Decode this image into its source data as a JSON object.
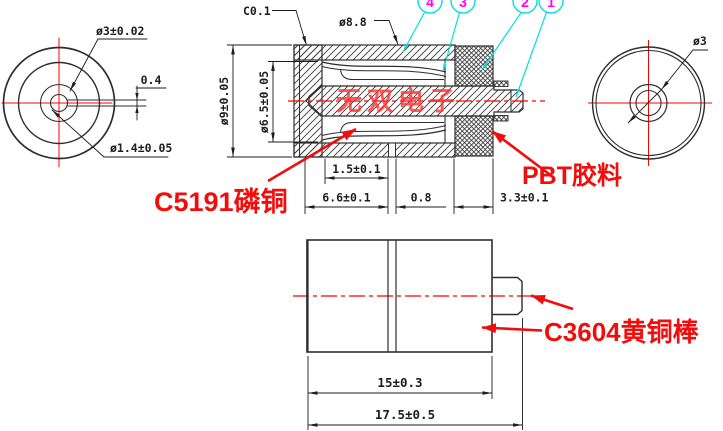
{
  "drawing": {
    "watermark": "无双电子",
    "colors": {
      "line": "#2e2e2e",
      "accent_red": "#f20d0d",
      "centerline_red": "#ff0000",
      "balloon_cyan": "#00e0e0",
      "balloon_num_magenta": "#ff00ff"
    },
    "balloons": [
      "4",
      "3",
      "2",
      "1"
    ],
    "left_view": {
      "outer_dia": "ø3±0.02",
      "slot_width": "0.4",
      "pin_dia": "ø1.4±0.05"
    },
    "section_view": {
      "chamfer": "C0.1",
      "shell_outer_dia": "ø8.8",
      "body_dia": "ø9±0.05",
      "bore_dia": "ø6.5±0.05",
      "dim_slot_pos": "1.5±0.1",
      "dim_front_len": "6.6±0.1",
      "dim_slot": "0.8",
      "dim_pbt_len": "3.3±0.1",
      "label_spring": "C5191磷铜",
      "label_plastic": "PBT胶料"
    },
    "right_view": {
      "pin_dia": "ø3"
    },
    "bottom_view": {
      "dim_body_len": "15±0.3",
      "dim_total_len": "17.5±0.5",
      "label_material": "C3604黄铜棒"
    }
  }
}
